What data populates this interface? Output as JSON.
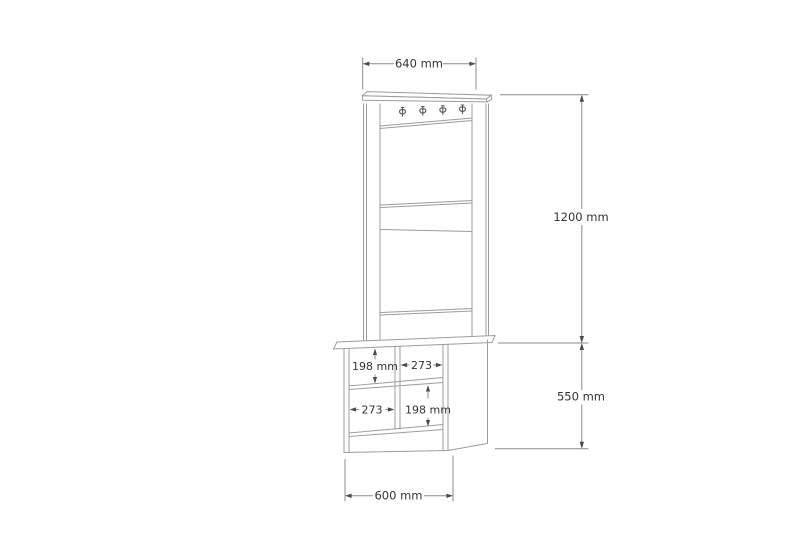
{
  "drawing": {
    "labels": {
      "overall_width": "640 mm",
      "upper_section_height": "1200 mm",
      "lower_section_height": "550 mm",
      "base_width": "600 mm",
      "top_left_compartment_height": "198 mm",
      "top_right_compartment_width": "273",
      "bottom_left_compartment_width": "273",
      "bottom_right_compartment_height": "198 mm"
    },
    "hooks": {
      "count": 4
    },
    "colors": {
      "background": "#ffffff",
      "outline": "#9c9c9c",
      "dimension_line": "#8b8b8b",
      "arrow": "#4a4a4a",
      "text": "#333333"
    }
  }
}
